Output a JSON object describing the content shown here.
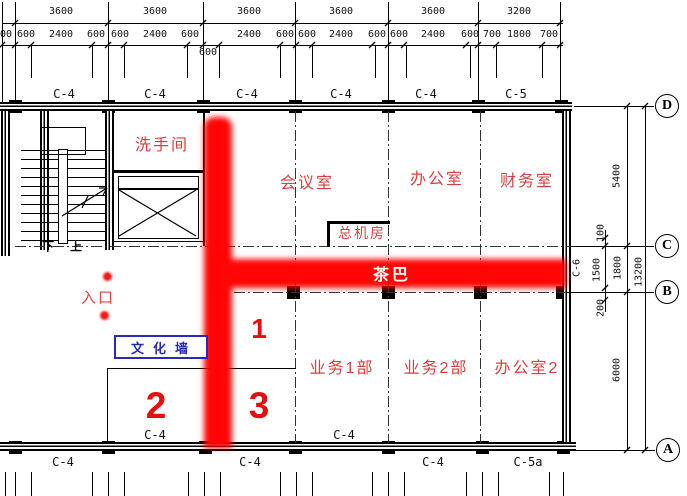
{
  "colors": {
    "highlight_red": "#ff0505",
    "label_red": "#d64040",
    "number_red": "#e50f0f",
    "sign_blue": "#2a2ab8",
    "line_black": "#000000"
  },
  "top_dims": {
    "row1": [
      "3600",
      "3600",
      "3600",
      "3600",
      "3600",
      "3200"
    ],
    "row2": [
      "600",
      "600",
      "2400",
      "600",
      "600",
      "2400",
      "600",
      "2400",
      "600",
      "600",
      "2400",
      "600",
      "600",
      "2400",
      "600",
      "700",
      "1800",
      "700"
    ],
    "row2_dropped": "600"
  },
  "grid": {
    "top_labels": [
      "C-4",
      "C-4",
      "C-4",
      "C-4",
      "C-4",
      "C-5"
    ],
    "bottom_above_labels": [
      "C-4",
      "C-4"
    ],
    "bottom_below_labels": [
      "C-4",
      "C-4",
      "C-4",
      "C-5a"
    ],
    "right_wall_tag": "C-6",
    "row_bubbles": [
      "D",
      "C",
      "B",
      "A"
    ]
  },
  "right_dims": {
    "d_to_c": "5400",
    "sub_100": "100",
    "sub_1500": "1500",
    "c_to_b": "1800",
    "sub_200": "200",
    "b_to_a": "6000",
    "total": "13200"
  },
  "rooms": {
    "washroom": "洗手间",
    "meeting_room": "会议室",
    "office": "办公室",
    "finance_room": "财务室",
    "switchboard_room": "总机房",
    "tea_bar": "茶巴",
    "sales_dept_1": "业务1部",
    "sales_dept_2": "业务2部",
    "office_2": "办公室2"
  },
  "annotations": {
    "entrance": "入口",
    "culture_wall": "文化墙",
    "route_1": "1",
    "route_2": "2",
    "route_3": "3",
    "stair_down": "下",
    "stair_up": "上"
  }
}
